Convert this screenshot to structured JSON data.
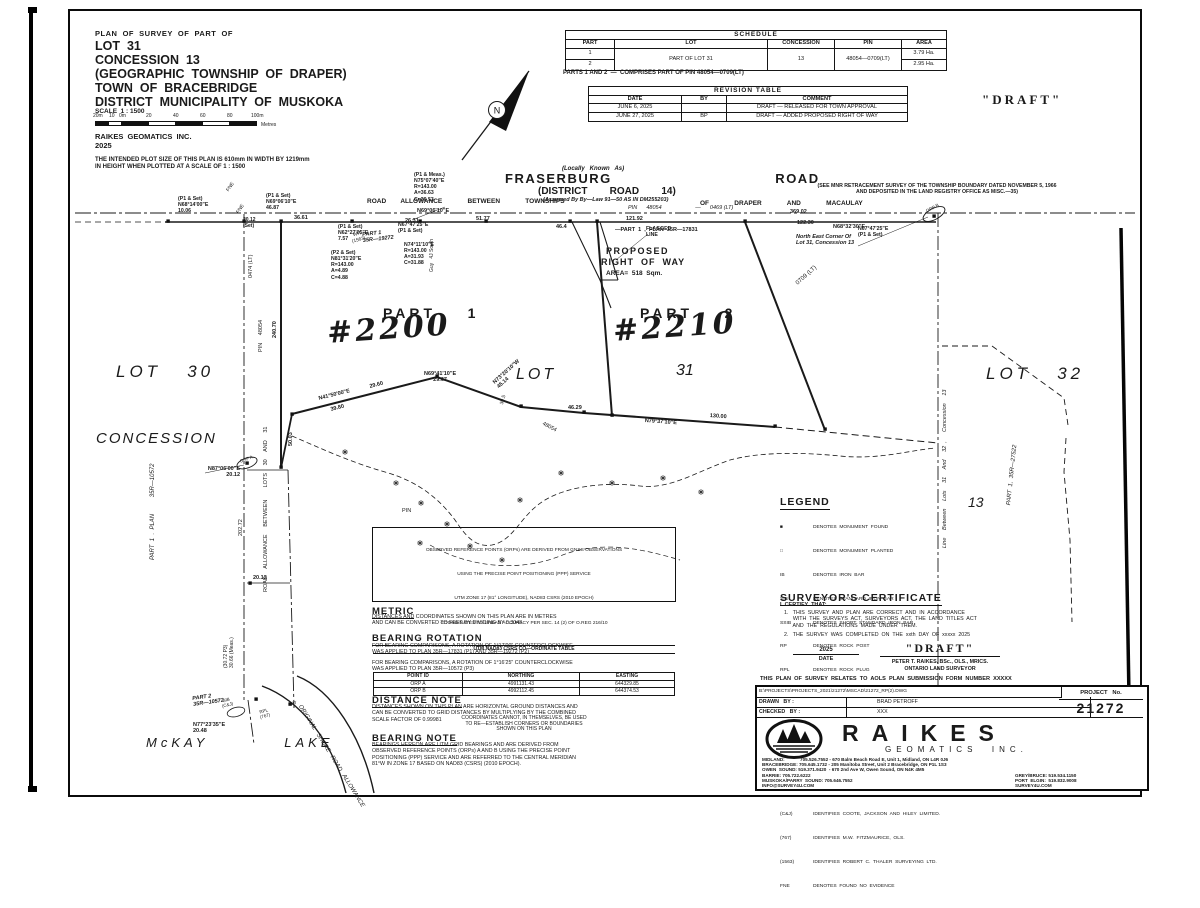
{
  "title_block": {
    "line0": "PLAN  OF  SURVEY  OF  PART  OF",
    "line1": "LOT  31",
    "line2": "CONCESSION  13",
    "line3": "(GEOGRAPHIC  TOWNSHIP  OF  DRAPER)",
    "line4": "TOWN  OF  BRACEBRIDGE",
    "line5": "DISTRICT  MUNICIPALITY  OF  MUSKOKA",
    "scale": "SCALE  1 : 1500",
    "scale_ticks": [
      "20m",
      "10",
      "0m",
      "20",
      "40",
      "60",
      "80",
      "100m"
    ],
    "scale_unit": "Metres",
    "firm": "RAIKES  GEOMATICS  INC.",
    "year": "2025",
    "plot_note": "THE INTENDED PLOT SIZE OF THIS PLAN IS 610mm IN WIDTH BY 1219mm\nIN HEIGHT WHEN PLOTTED AT A SCALE OF 1 : 1500"
  },
  "draft_stamp": "\"DRAFT\"",
  "schedule": {
    "title": "SCHEDULE",
    "headers": [
      "PART",
      "LOT",
      "CONCESSION",
      "PIN",
      "AREA"
    ],
    "rows": [
      [
        "1",
        "PART  OF  LOT  31",
        "13",
        "48054—0709(LT)",
        "3.79 Ha."
      ],
      [
        "2",
        "",
        "",
        "",
        "2.95 Ha."
      ]
    ],
    "note": "PARTS 1 AND 2  —  COMPRISES PART OF PIN 48054—0709(LT)"
  },
  "revision_table": {
    "title": "REVISION  TABLE",
    "headers": [
      "DATE",
      "BY",
      "COMMENT"
    ],
    "rows": [
      [
        "JUNE 6, 2025",
        "",
        "DRAFT  —  RELEASED  FOR  TOWN  APPROVAL"
      ],
      [
        "JUNE 27, 2025",
        "BP",
        "DRAFT  —  ADDED  PROPOSED  RIGHT  OF  WAY"
      ]
    ]
  },
  "plan": {
    "north_n": "N",
    "locally": "(Locally   Known   As)",
    "name": "FRASERBURG                                ROAD",
    "district": "(DISTRICT        ROAD        14)",
    "bylaw": "(Assumed By By—Law 91—50 AS IN DM255203)",
    "allowance_left": "ROAD        ALLOWANCE              BETWEEN              TOWNSHIPS",
    "allowance_right": "OF              DRAPER              AND              MACAULAY",
    "pin0469": "PIN      48054                      —      0469 (LT)",
    "mnr": "(SEE MNR RETRACEMENT SURVEY OF THE TOWNSHIP BOUNDARY DATED NOVEMBER 5, 1966\nAND DEPOSITED IN THE LAND REGISTRY OFFICE AS MISC.—35)",
    "c_p1meas": "(P1 & Meas.)\nN75°07'40\"E\nR=143.00\nA=36.63\nC=36.53",
    "c_p1set1": "(P1 & Set)\nN68°14'00\"E\n10.06",
    "c_p1set2": "(P1 & Set)\nN69°06'10\"E\n46.87",
    "c_2012": "20.12\n(Set)",
    "c_n6227": "(P1 & Set)\nN62°27'05\"E\n7.57",
    "c_p2set": "(P2 & Set)\nN81°31'20\"E\nR=143.00\nA=4.89\nC=4.88",
    "c_n7411": "N74°11'10\"E\nR=143.00\nA=31.93\nC=31.88",
    "c_n6747": "N67°47'25\"E\n(P1 & Set)",
    "part1_19272": "PART 1\n35R—19272",
    "guy": "Guy   4J South",
    "fne": "FNE",
    "tag_1563": "WIT\n(1563)",
    "d36_61": "36.61",
    "d26_31": "26.31",
    "b_n6906": "N69°06'10\"E",
    "d51_77": "51.77",
    "d46_4": "46.4",
    "d121_92": "121.92",
    "part1_17831": "—PART  1  ,  PLAN  35R—17831",
    "b_n6832": "N68°32'30\"E",
    "d369_02": "369.02",
    "d122_30": "122.30",
    "necorner": "North East Corner Of\nLot 31, Concession 13",
    "orp_b": "ORP B",
    "orp_a": "ORP A",
    "flagged": "FLAGGED\nLINE",
    "row1": "PROPOSED",
    "row2": "RIGHT  OF  WAY",
    "row3": "AREA=  518  Sqm.",
    "part1": "PART    1",
    "part2": "PART    2",
    "addr1": "#2200",
    "addr2": "#2210",
    "lot30": "LOT   30",
    "lot31a": "LOT",
    "lot31b": "31",
    "lot32": "LOT   32",
    "conc_left": "CONCESSION",
    "conc13": "13",
    "left_rot": "PART  1  .  PLAN          35R—10572",
    "pin0474": "0474 (LT)",
    "v_pin48054": "PIN     48054",
    "v_24070": "240.70",
    "tie_n8706": "N87°06'00\"E\n20.12",
    "v_5003": "50.03",
    "b_n4150": "N41°50'00\"E",
    "d39_80": "39.80",
    "d29_60": "29.60",
    "b_n6941": "N69°41'10\"E\n29.67",
    "b_n7320": "N73°20'10\"W\n45.14",
    "d30_5": "30.5",
    "d46_29": "46.29",
    "b_n7937": "N79°37'10\"E",
    "d130": "130.00",
    "pin48054d": "48054",
    "pin_word": "PIN",
    "pin0709": "0709  (LT)",
    "right_rot": "Line     Between     Lots     31     And     32  ,      Concession     13",
    "part1_27522": "PART  1,  35R—27522",
    "alw_rot": "ROAD     ALLOWANCE     BETWEEN        LOTS     30     AND     31",
    "v_20272": "202.72",
    "v_2012b": "20.12",
    "v_3072": "(30.72 P3)\n30.66 (Meas.)",
    "part_10572b": "PART 2\n35R—10572",
    "b_n7723": "N77°23'35\"E\n20.48",
    "tag_cj": "SIB\n(C&J)",
    "tag_767": "RPL\n(767)",
    "tag_wit": "WIT",
    "mckay": "McKAY          LAKE",
    "shore": "ORIGINAL   SHORE   ROAD   ALLOWANCE"
  },
  "orp_table": {
    "note1": "OBSERVED  REFERENCE  POINTS  (ORPs)  ARE  DERIVED  FROM  GNSS  OBSERVATIONS",
    "note2": "USING  THE  PRECISE  POINT  POSITIONING  (PPP)  SERVICE",
    "note3": "UTM  ZONE  17  (81°  LONGITUDE),  NAD83  CSRS  (2010  EPOCH)",
    "note4": "COORDINATES  TO  URBAN  ACCURACY  PER  SEC.  14  (2)  OF  O.REG  216/10",
    "table_title": "UTM  NAD83  CSRS  CO—ORDINATE  TABLE",
    "headers": [
      "POINT ID",
      "NORTHING",
      "EASTING"
    ],
    "rows": [
      [
        "ORP  A",
        "4991131.43",
        "644329.85"
      ],
      [
        "ORP  B",
        "4992112.45",
        "644374.53"
      ]
    ],
    "footer": "COORDINATES  CANNOT,  IN  THEMSELVES,  BE  USED\nTO  RE—ESTABLISH  CORNERS  OR  BOUNDARIES\nSHOWN  ON  THIS  PLAN"
  },
  "notes": {
    "metric_title": "METRIC",
    "metric_body": "DISTANCES AND COORDINATES SHOWN ON THIS PLAN ARE IN METRES\nAND CAN BE CONVERTED TO FEET BY DIVIDING BY 0.3048",
    "bearing_rotation_title": "BEARING  ROTATION",
    "bearing_rotation_b1": "FOR BEARING COMPARISONS, A ROTATION OF 1°17'00\" COUNTERCLOCKWISE\nWAS APPLIED TO PLAN 35R—17831 (P1) AND 35R—19272 (P2)",
    "bearing_rotation_b2": "FOR BEARING COMPARISONS, A ROTATION OF 1°16'25\" COUNTERCLOCKWISE\nWAS APPLIED TO PLAN 35R—10572 (P3)",
    "distance_title": "DISTANCE  NOTE",
    "distance_body": "DISTANCES SHOWN ON THIS PLAN ARE HORIZONTAL GROUND DISTANCES AND\nCAN BE CONVERTED TO GRID DISTANCES BY MULTIPLYING BY THE COMBINED\nSCALE FACTOR OF 0.99981",
    "bearing_note_title": "BEARING  NOTE",
    "bearing_note_body": "BEARINGS HEREON ARE UTM GRID BEARINGS AND ARE DERIVED FROM\nOBSERVED REFERENCE POINTS (ORPs) A AND B USING THE PRECISE POINT\nPOSITIONING (PPP) SERVICE AND ARE REFERRED TO THE CENTRAL MERIDIAN\n81°W IN ZONE 17 BASED ON NAD83 (CSRS) (2010 EPOCH)."
  },
  "legend": {
    "title": "LEGEND",
    "items": [
      [
        "■",
        "DENOTES  MONUMENT  FOUND"
      ],
      [
        "□",
        "DENOTES  MONUMENT  PLANTED"
      ],
      [
        "IB",
        "DENOTES  IRON  BAR"
      ],
      [
        "SIB",
        "DENOTES  STANDARD  IRON  BAR"
      ],
      [
        "SSIB",
        "DENOTES  SHORT  STANDARD  IRON  BAR"
      ],
      [
        "RP",
        "DENOTES  ROCK  POST"
      ],
      [
        "RPL",
        "DENOTES  ROCK  PLUG"
      ],
      [
        "Meas.",
        "DENOTES  MEASURED"
      ],
      [
        "P1",
        "DENOTES  PLAN  35R—17831"
      ],
      [
        "P2",
        "DENOTES  PLAN  35R—19272"
      ],
      [
        "P3",
        "DENOTES  PLAN  35R—10572"
      ],
      [
        "WIT.",
        "DENOTES  WITNESS"
      ],
      [
        "(C&J)",
        "IDENTIFIES  COOTE,  JACKSON  AND  HILEY  LIMITED."
      ],
      [
        "(767)",
        "IDENTIFIES  M.W.  FITZMAURICE,  OLS."
      ],
      [
        "(1563)",
        "IDENTIFIES  ROBERT  C.  THALER  SURVEYING  LTD."
      ],
      [
        "FNE",
        "DENOTES  FOUND  NO  EVIDENCE"
      ]
    ]
  },
  "certificate": {
    "title": "SURVEYOR'S  CERTIFICATE",
    "intro": "I  CERTIFY  THAT:",
    "item1": "1.   THIS  SURVEY  AND  PLAN  ARE  CORRECT  AND  IN  ACCORDANCE\n      WITH  THE  SURVEYS  ACT,  SURVEYORS  ACT,  THE  LAND  TITLES  ACT\n      AND  THE  REGULATIONS  MADE  UNDER  THEM.",
    "item2": "2.   THE  SURVEY  WAS  COMPLETED  ON  THE  xxth  DAY  OF  xxxxx  2025",
    "date_value": "2025",
    "date_label": "DATE",
    "sig": "\"DRAFT\"",
    "surveyor": "PETER  T.  RAIKES,  BSc.,  OLS.,  MRICS.",
    "surveyor2": "ONTARIO  LAND  SURVEYOR",
    "aols": "THIS  PLAN  OF  SURVEY  RELATES  TO  AOLS  PLAN  SUBMISSION  FORM  NUMBER  XXXXX"
  },
  "title_bar": {
    "file_path": "B:\\PROJECTS\\PROJECTS_2021\\21272\\MSCAD\\21272_RP(2).DWG",
    "drawn_label": "DRAWN   BY :",
    "drawn_value": "BRAD PETROFF",
    "checked_label": "CHECKED   BY :",
    "checked_value": "XXX",
    "project_label": "PROJECT   No.",
    "project_value": "21272",
    "brand": "RAIKES",
    "brand2": "GEOMATICS  INC.",
    "contact_l1": "MIDLAND:            705.526.7552 - 670 Balm Beach Road E, Unit 1, Midland, ON L4R 0J6",
    "contact_l2": "BRACEBRIDGE: 705.645.1732 - 205 Manitoba Street, Unit 2 Bracebridge, ON P1L 1S3",
    "contact_l3": "OWEN  SOUND: 519.371.9420  - 670 2nd Ave W, Owen Sound, ON N4K 4M5",
    "contact_l4": "BARRIE: 705.722.6222",
    "contact_l5": "MUSKOKA/PARRY  SOUND: 705.646.7552",
    "contact_l6": "INFO@SURVEY4U.COM",
    "contact_r1": "GREY/BRUCE: 519.534.1150",
    "contact_r2": "PORT  ELGIN:  519.832.9008",
    "contact_r3": "SURVEY4U.COM"
  }
}
